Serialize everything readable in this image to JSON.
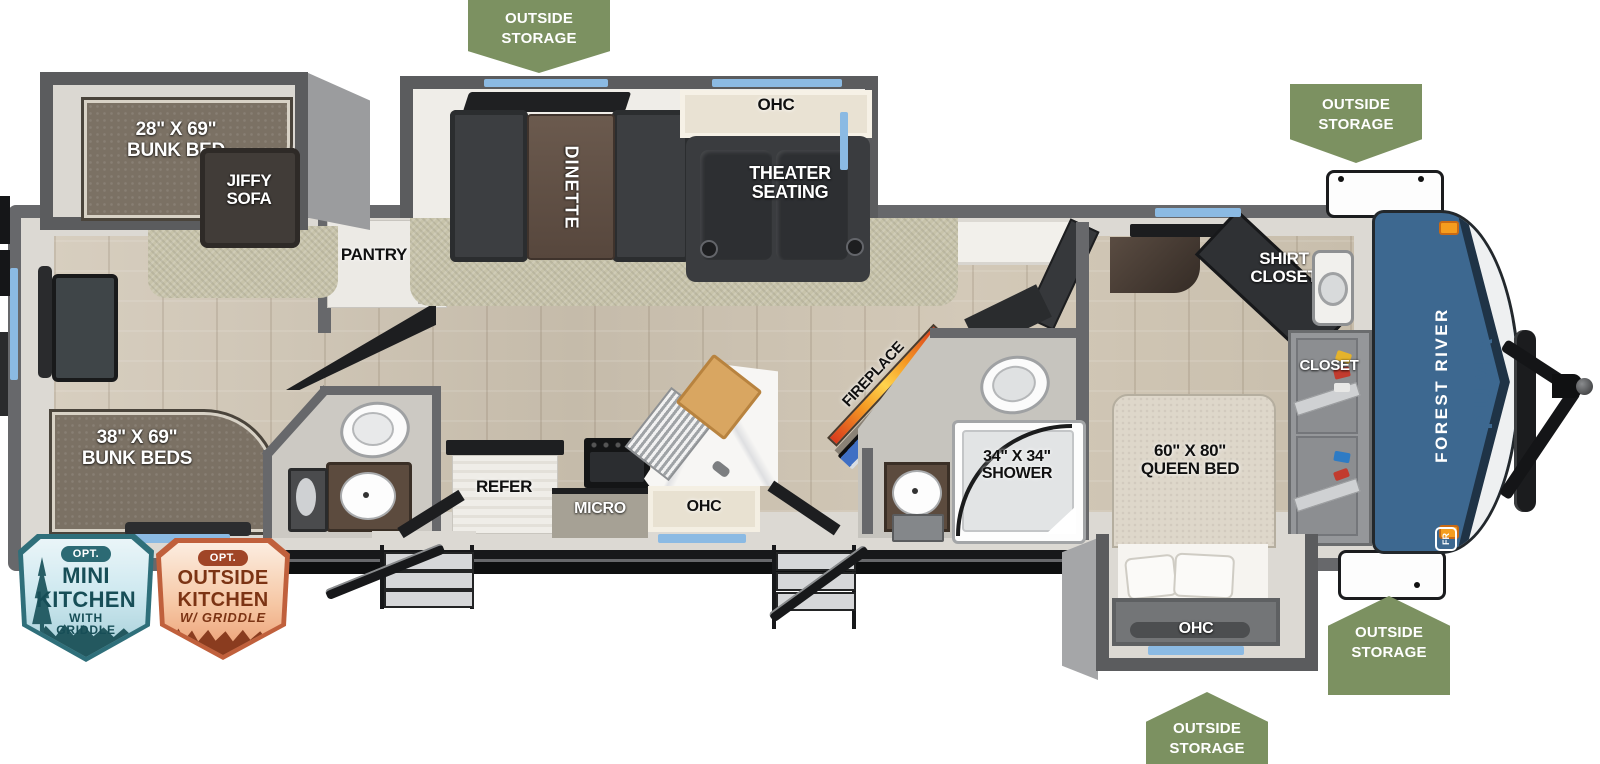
{
  "page": {
    "description": "Forest River Puma travel trailer floorplan (top view)"
  },
  "brand": {
    "fr_monogram": "FR",
    "manufacturer": "FOREST RIVER",
    "model": "PUMA"
  },
  "storage_badges": [
    {
      "id": "top-left",
      "line1": "OUTSIDE",
      "line2": "STORAGE"
    },
    {
      "id": "front-top",
      "line1": "OUTSIDE",
      "line2": "STORAGE"
    },
    {
      "id": "front-bottom",
      "line1": "OUTSIDE",
      "line2": "STORAGE"
    },
    {
      "id": "bedroom-bottom",
      "line1": "OUTSIDE",
      "line2": "STORAGE"
    }
  ],
  "option_badges": {
    "mini_kitchen": {
      "opt": "OPT.",
      "line1": "MINI",
      "line2": "KITCHEN",
      "sub1": "WITH",
      "sub2": "GRIDDLE"
    },
    "outside_kitchen": {
      "opt": "OPT.",
      "line1": "OUTSIDE",
      "line2": "KITCHEN",
      "sub1": "W/ GRIDDLE"
    }
  },
  "labels": {
    "bunk_slide_size": "28\" X 69\"",
    "bunk_slide_name": "BUNK BED",
    "jiffy1": "JIFFY",
    "jiffy2": "SOFA",
    "rear_bunks_size": "38\" X 69\"",
    "rear_bunks_name": "BUNK BEDS",
    "pantry": "PANTRY",
    "dinette": "DINETTE",
    "theater1": "THEATER",
    "theater2": "SEATING",
    "ohc": "OHC",
    "refer": "REFER",
    "micro": "MICRO",
    "fireplace": "FIREPLACE",
    "ent_center": "ENT. CENTER",
    "shower_size": "34\" X 34\"",
    "shower_name": "SHOWER",
    "shirt_closet1": "SHIRT",
    "shirt_closet2": "CLOSET",
    "closet": "CLOSET",
    "queen_size": "60\" X 80\"",
    "queen_name": "QUEEN BED"
  },
  "colors": {
    "badge_green": "#7c9161",
    "cap_blue": "#3d6890",
    "window_blue": "#8bbae3",
    "mini_badge_teal": "#2c6a74",
    "outside_badge_orange": "#c0603c"
  }
}
